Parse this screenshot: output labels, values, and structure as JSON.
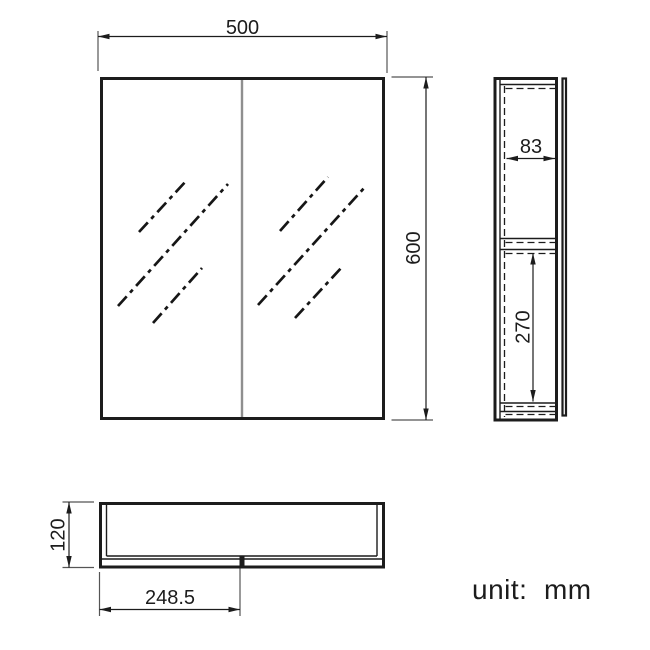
{
  "note": {
    "unit_label": "unit:  mm"
  },
  "dimensions": {
    "front_width": "500",
    "front_height": "600",
    "side_inner_depth": "83",
    "side_lower_section_height": "270",
    "plan_depth": "120",
    "plan_door_half_width": "248.5"
  },
  "colors": {
    "line": "#1c1c1c",
    "door_divider_gray": "#8f8f8f",
    "background": "#ffffff"
  }
}
